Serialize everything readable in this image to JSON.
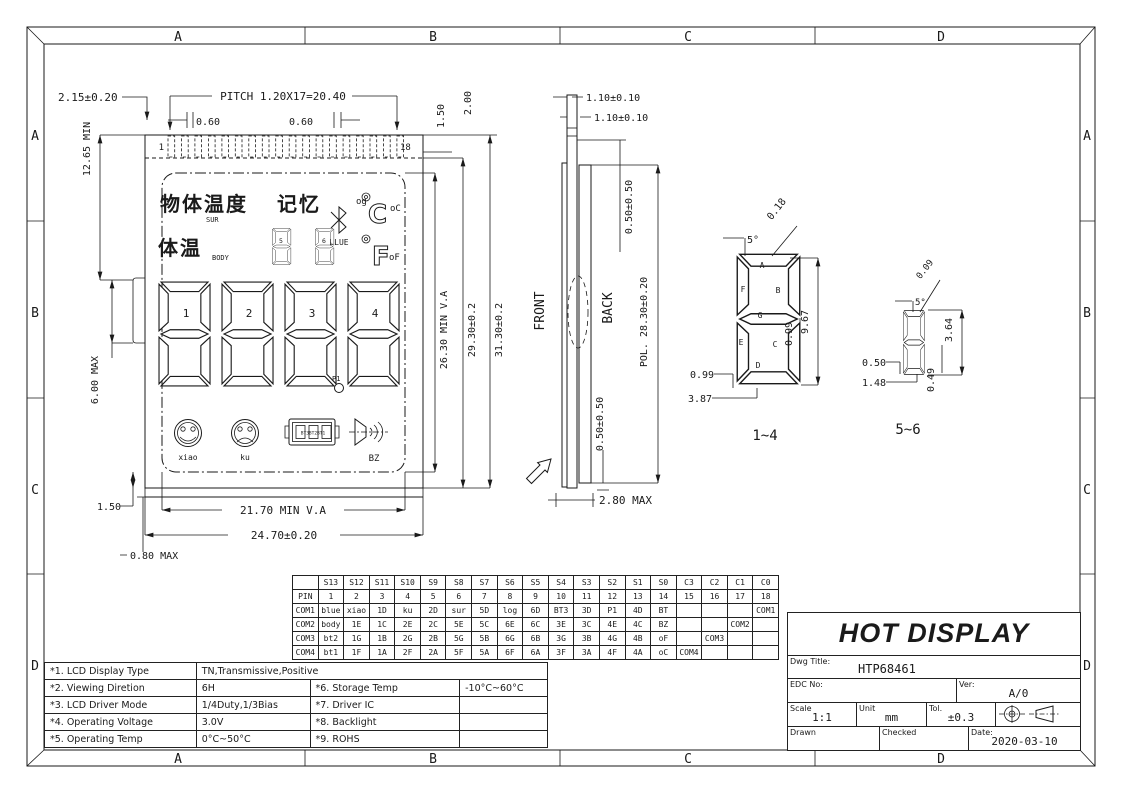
{
  "zones": [
    "A",
    "B",
    "C",
    "D"
  ],
  "front_view": {
    "pin_first": "1",
    "pin_last": "18",
    "dims": {
      "d215": "2.15±0.20",
      "pitch": "PITCH 1.20X17=20.40",
      "d060a": "0.60",
      "d060b": "0.60",
      "d150top": "1.50",
      "d200": "2.00",
      "d1265": "12.65 MIN",
      "d600": "6.00 MAX",
      "d150bl": "1.50",
      "d080": "0.80 MAX",
      "d2170": "21.70 MIN V.A",
      "d2470": "24.70±0.20",
      "d2630": "26.30 MIN V.A",
      "d2930": "29.30±0.2",
      "d3130": "31.30±0.2"
    }
  },
  "lcd": {
    "surface_cn": "物体温度",
    "surface_sub": "SUR",
    "memory_cn": "记忆",
    "log_small": "og",
    "blue": "BLUE",
    "c_glyph": "C",
    "c_label": "oC",
    "body_cn": "体温",
    "body_en": "BODY",
    "f_glyph": "F",
    "f_label": "oF",
    "digits": [
      "1",
      "2",
      "3",
      "4"
    ],
    "small_digits": [
      "5",
      "6"
    ],
    "p1": "P1",
    "icons": {
      "smile": "xiao",
      "sad": "ku",
      "battery_cells": "BT3BT2BT1",
      "buzzer": "BZ"
    }
  },
  "side_view": {
    "front": "FRONT",
    "back": "BACK",
    "dims": {
      "d110a": "1.10±0.10",
      "d110b": "1.10±0.10",
      "d050t": "0.50±0.50",
      "pol": "POL. 28.30±0.20",
      "d050b": "0.50±0.50",
      "d280": "2.80 MAX"
    }
  },
  "segment_details": {
    "d1": {
      "title": "1~4",
      "letters": [
        "A",
        "B",
        "C",
        "D",
        "E",
        "F",
        "G"
      ],
      "dims": {
        "w018": "0.18",
        "a5": "5°",
        "h967": "9.67",
        "w099": "0.99",
        "b099": "0.99",
        "b387": "3.87"
      }
    },
    "d2": {
      "title": "5~6",
      "dims": {
        "w009": "0.09",
        "a5": "5°",
        "h364": "3.64",
        "b050": "0.50",
        "b148": "1.48",
        "w049": "0.49"
      }
    }
  },
  "pin_table": {
    "header": [
      "",
      "S13",
      "S12",
      "S11",
      "S10",
      "S9",
      "S8",
      "S7",
      "S6",
      "S5",
      "S4",
      "S3",
      "S2",
      "S1",
      "S0",
      "C3",
      "C2",
      "C1",
      "C0"
    ],
    "rows": [
      [
        "PIN",
        "1",
        "2",
        "3",
        "4",
        "5",
        "6",
        "7",
        "8",
        "9",
        "10",
        "11",
        "12",
        "13",
        "14",
        "15",
        "16",
        "17",
        "18"
      ],
      [
        "COM1",
        "blue",
        "xiao",
        "1D",
        "ku",
        "2D",
        "sur",
        "5D",
        "log",
        "6D",
        "BT3",
        "3D",
        "P1",
        "4D",
        "BT",
        "",
        "",
        "",
        "COM1"
      ],
      [
        "COM2",
        "body",
        "1E",
        "1C",
        "2E",
        "2C",
        "5E",
        "5C",
        "6E",
        "6C",
        "3E",
        "3C",
        "4E",
        "4C",
        "BZ",
        "",
        "",
        "COM2",
        ""
      ],
      [
        "COM3",
        "bt2",
        "1G",
        "1B",
        "2G",
        "2B",
        "5G",
        "5B",
        "6G",
        "6B",
        "3G",
        "3B",
        "4G",
        "4B",
        "oF",
        "",
        "COM3",
        "",
        ""
      ],
      [
        "COM4",
        "bt1",
        "1F",
        "1A",
        "2F",
        "2A",
        "5F",
        "5A",
        "6F",
        "6A",
        "3F",
        "3A",
        "4F",
        "4A",
        "oC",
        "COM4",
        "",
        "",
        ""
      ]
    ]
  },
  "spec_table": {
    "rows": [
      [
        {
          "t": "*1. LCD Display Type"
        },
        {
          "t": "TN,Transmissive,Positive",
          "span": 3
        }
      ],
      [
        {
          "t": "*2. Viewing Diretion"
        },
        {
          "t": "6H"
        },
        {
          "t": "*6. Storage Temp"
        },
        {
          "t": "-10°C~60°C"
        }
      ],
      [
        {
          "t": "*3. LCD Driver Mode"
        },
        {
          "t": "1/4Duty,1/3Bias"
        },
        {
          "t": "*7. Driver IC"
        },
        {
          "t": ""
        }
      ],
      [
        {
          "t": "*4. Operating Voltage"
        },
        {
          "t": "3.0V"
        },
        {
          "t": "*8. Backlight"
        },
        {
          "t": ""
        }
      ],
      [
        {
          "t": "*5. Operating Temp"
        },
        {
          "t": "0°C~50°C"
        },
        {
          "t": "*9. ROHS"
        },
        {
          "t": ""
        }
      ]
    ]
  },
  "title_block": {
    "company": "HOT DISPLAY",
    "dwg_title_label": "Dwg Title:",
    "dwg_title": "HTP68461",
    "edc_label": "EDC No:",
    "ver_label": "Ver:",
    "ver": "A/0",
    "scale_label": "Scale",
    "scale": "1:1",
    "unit_label": "Unit",
    "unit": "mm",
    "tol_label": "Tol.",
    "tol": "±0.3",
    "drawn_label": "Drawn",
    "checked_label": "Checked",
    "date_label": "Date:",
    "date": "2020-03-10"
  }
}
